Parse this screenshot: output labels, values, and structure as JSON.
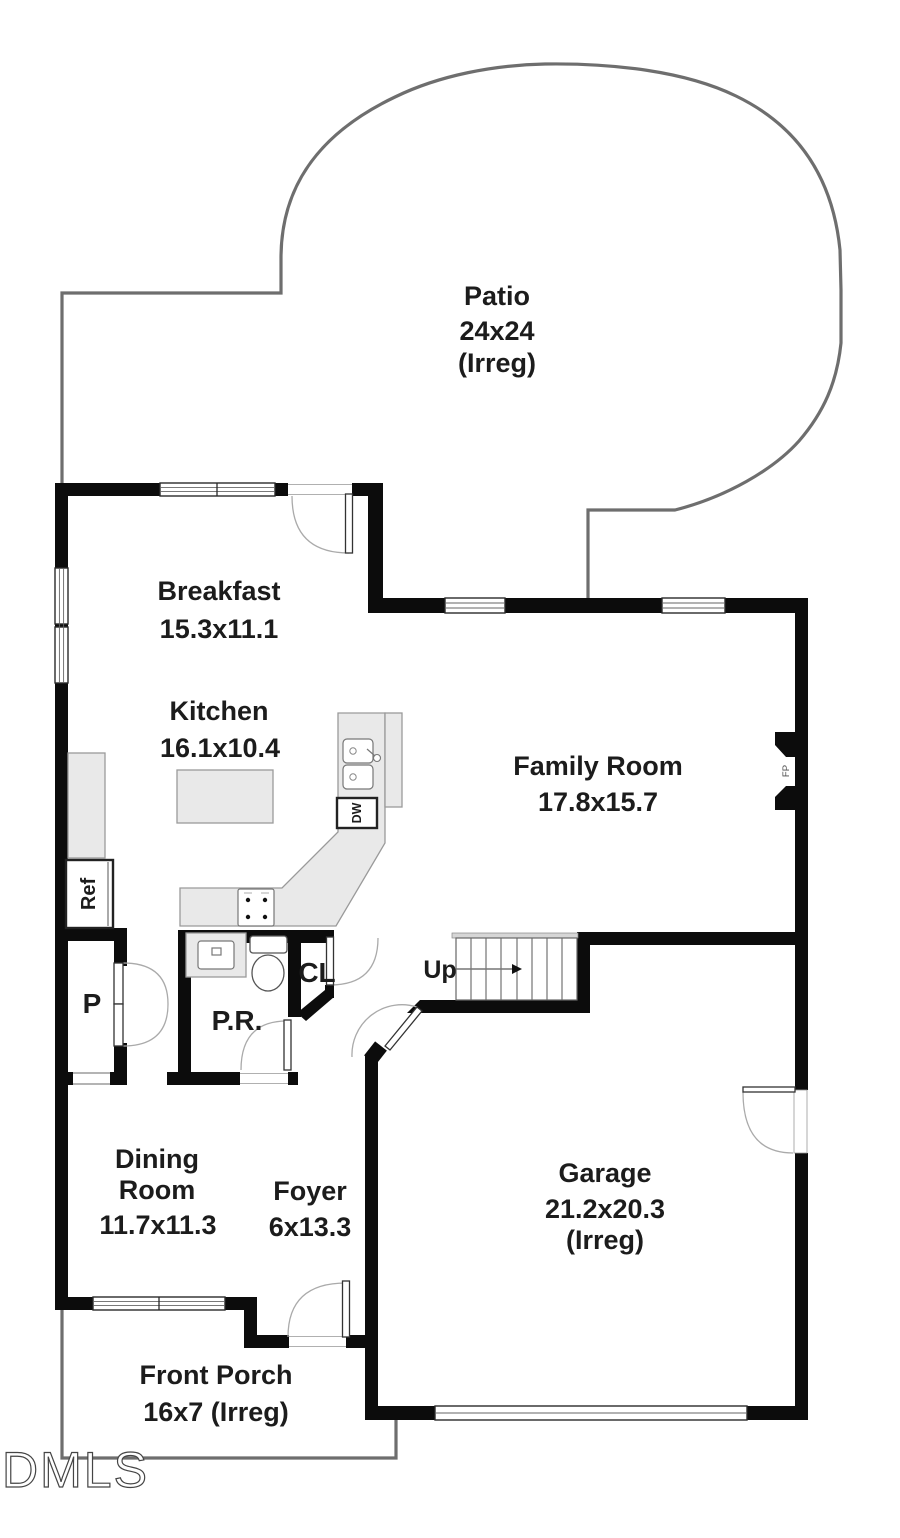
{
  "title": "First floor plan",
  "watermark": "DMLS",
  "colors": {
    "wall": "#0c0c0c",
    "exterior_outline": "#6e6e6e",
    "counter_fill": "#e9e9e9",
    "text": "#1c1c1c"
  },
  "rooms": {
    "patio": {
      "name": "Patio",
      "dims": "24x24",
      "note": "(Irreg)"
    },
    "breakfast": {
      "name": "Breakfast",
      "dims": "15.3x11.1"
    },
    "kitchen": {
      "name": "Kitchen",
      "dims": "16.1x10.4"
    },
    "family_room": {
      "name": "Family Room",
      "dims": "17.8x15.7"
    },
    "dining_room": {
      "name_line1": "Dining",
      "name_line2": "Room",
      "dims": "11.7x11.3"
    },
    "foyer": {
      "name": "Foyer",
      "dims": "6x13.3"
    },
    "garage": {
      "name": "Garage",
      "dims": "21.2x20.3",
      "note": "(Irreg)"
    },
    "front_porch": {
      "name": "Front Porch",
      "dims": "16x7 (Irreg)"
    }
  },
  "labels": {
    "pantry": "P",
    "powder_room": "P.R.",
    "closet": "CL",
    "stairs_up": "Up",
    "refrigerator": "Ref",
    "dishwasher": "DW",
    "fireplace": "FP"
  }
}
